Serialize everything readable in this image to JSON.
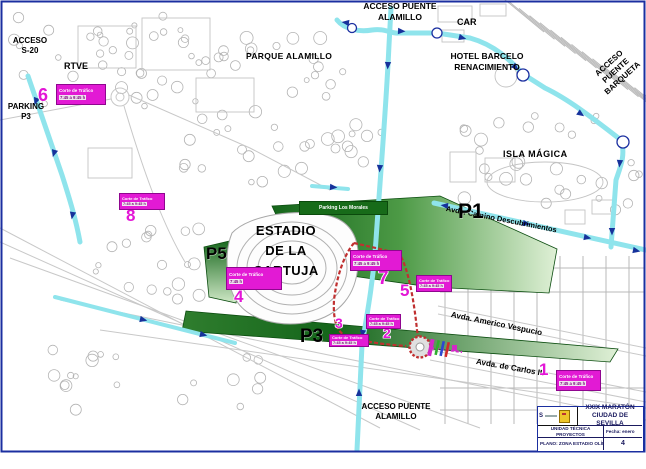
{
  "places": {
    "acceso_s20": "ACCESO\nS-20",
    "rtve": "RTVE",
    "parking_p3": "PARKING\nP3",
    "parque_alamillo": "PARQUE ALAMILLO",
    "acceso_puente_alamillo_norte": "ACCESO PUENTE\nALAMILLO",
    "car": "CAR",
    "hotel_barcelo": "HOTEL BARCELO\nRENACIMIENTO",
    "acceso_puente_barqueta": "ACCESO\nPUENTE\nBARQUETA",
    "isla_magica": "ISLA MÁGICA",
    "estadio": "ESTADIO\nDE LA\nCARTUJA",
    "acceso_puente_alamillo_sur": "ACCESO PUENTE\nALAMILLO"
  },
  "streets": {
    "descubrimientos": "Avda. Camino Descubrimientos",
    "vespucio": "Avda. Americo Vespucio",
    "carlos_iii": "Avda. de Carlos III"
  },
  "parking": {
    "p1": "P1",
    "p3": "P3",
    "p5": "P5",
    "p1_banner": "Parking Los Morales"
  },
  "markers": {
    "items": [
      {
        "number": "1",
        "note1": "Corte de Tráfico",
        "note2": "7:45 a 9:45 h"
      },
      {
        "number": "2",
        "note1": "Corte de Tráfico",
        "note2": "7:45 a 9:45 h"
      },
      {
        "number": "3",
        "note1": "Corte de Tráfico",
        "note2": "7:45 a 9:45 h"
      },
      {
        "number": "4",
        "note1": "Corte de Tráfico",
        "note2": "7:45 h"
      },
      {
        "number": "5",
        "note1": "Corte de Tráfico",
        "note2": "7:45 a 9:45 h"
      },
      {
        "number": "6",
        "note1": "Corte de Tráfico",
        "note2": "7:45 a 9:45 h"
      },
      {
        "number": "7",
        "note1": "Corte de Tráfico",
        "note2": "7:45 a 9:45 h"
      },
      {
        "number": "8",
        "note1": "Corte de Tráfico",
        "note2": "7:45 a 9:45 h"
      }
    ]
  },
  "title_block": {
    "logo_mark": "S",
    "title": "XXIX MARATÓN\nCIUDAD DE SEVILLA",
    "unit": "UNIDAD TÉCNICA\nPROYECTOS",
    "fecha": "Fecha: enero",
    "plano": "PLANO:  ZONA ESTADIO OLÍMPICO",
    "sheet": "4"
  },
  "colors": {
    "route_cyan": "#8fe4ec",
    "arrow_navy": "#16329b",
    "marker_magenta": "#e316d6",
    "closure_red": "#c03030",
    "parking_green_dark": "#14651a",
    "parking_green_light": "#dff0d6",
    "frame_navy": "#1b2fa0"
  }
}
